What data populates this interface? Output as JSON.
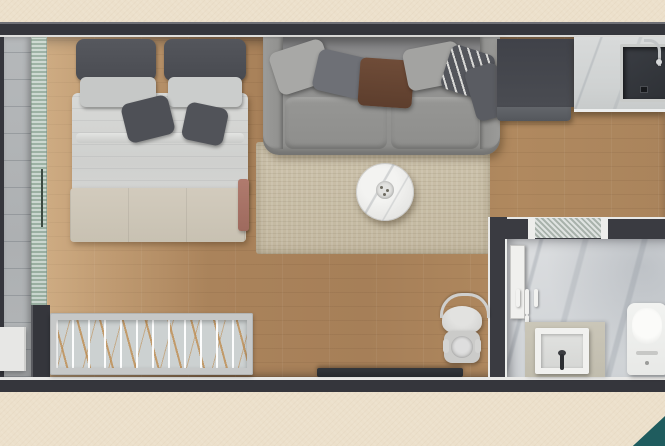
{
  "scene": {
    "type": "apartment-floor-plan-3d-render",
    "palette": {
      "background": "#ece0cb",
      "accent_corner": "#1f5c5e",
      "walls": "#35363c",
      "wall_liner": "#e9e9e7",
      "wood_floor": "#ab845c",
      "balcony_tile": "#b2b5b7",
      "glass": "#a1b6a9",
      "rug": "#c6bca5",
      "sofa": "#8e8e8c",
      "bedding": "#d4d5d3",
      "bench": "#ccc5b6",
      "bathroom_marble": "#d6d9db",
      "kitchen_counter_marble": "#d2d5d5",
      "dark_cabinet": "#45474d",
      "sink_basin": "#34373c",
      "accent_throw": "#a87468",
      "louver_lines": "#be8c50"
    },
    "rooms": [
      {
        "name": "balcony",
        "position": "left-strip"
      },
      {
        "name": "bedroom-living-area",
        "position": "center"
      },
      {
        "name": "kitchen",
        "position": "top-right"
      },
      {
        "name": "bathroom",
        "position": "bottom-right"
      }
    ],
    "labels": {
      "balcony": "Balcony",
      "glass_wall": "Sliding glass wall",
      "bed": "Double bed with pillows",
      "bed_bench": "Foot-of-bed bench",
      "red_throw": "Accent throw",
      "sofa": "Sofa with cushions",
      "rug": "Area rug",
      "coffee_table": "Round marble coffee table",
      "kitchen_cabinet": "Tall dark cabinet",
      "kitchen_counter": "Marble kitchen counter",
      "kitchen_sink": "Kitchen sink with faucet",
      "bathroom": "Bathroom",
      "bathroom_glass": "Frosted glass partition",
      "bathroom_door": "Open bathroom door",
      "towel_hooks": "Wall hooks fixture",
      "bathroom_sink": "Bathroom basin",
      "toilet": "Toilet",
      "desk": "Wall desk",
      "chair": "Chair",
      "louver": "Louvered technical vent",
      "balcony_bench": "Balcony step bench",
      "teal_corner": "Decorative corner graphic"
    }
  }
}
